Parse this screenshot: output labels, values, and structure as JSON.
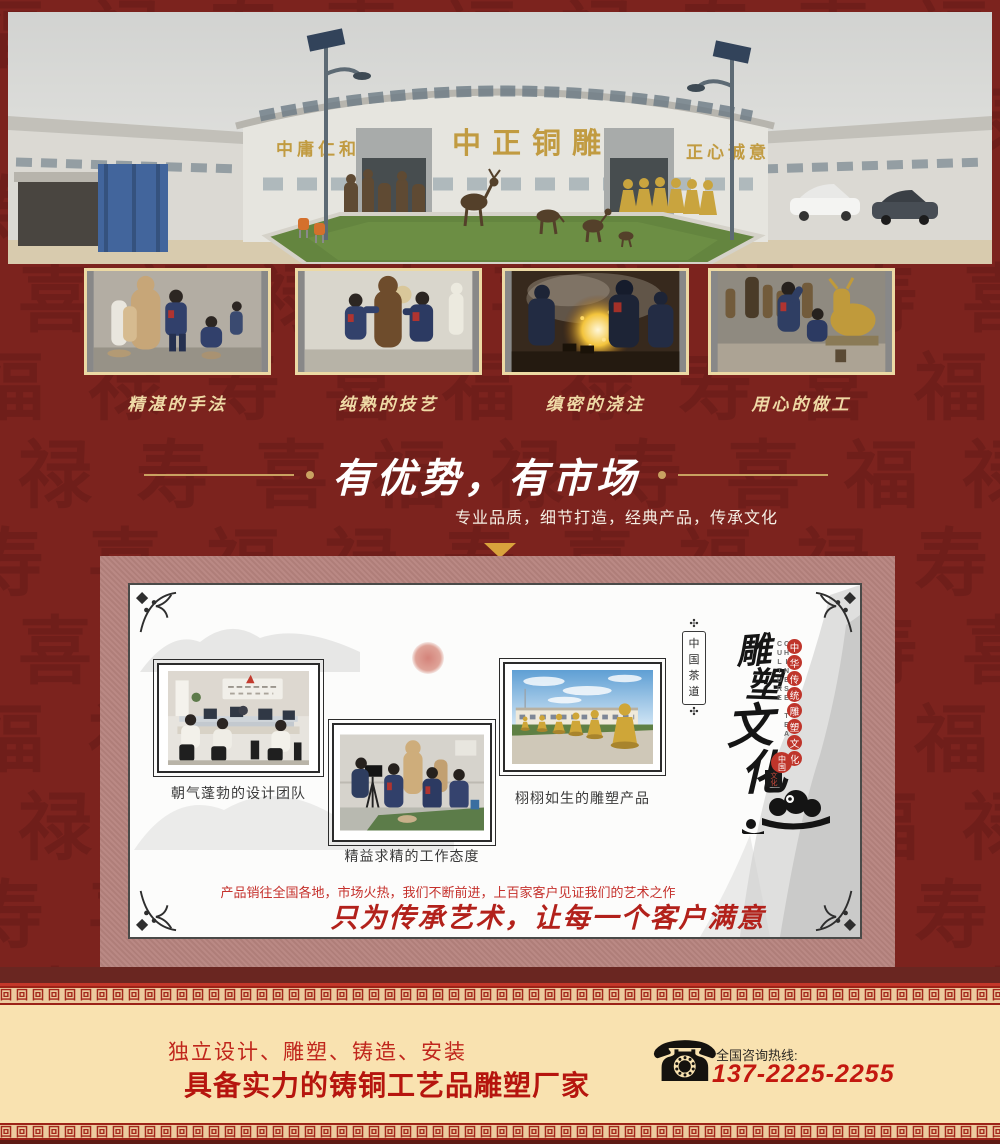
{
  "hero": {
    "sign_left": "中庸仁和",
    "sign_center": "中正铜雕",
    "sign_right": "正心诚意"
  },
  "process": {
    "items": [
      "精湛的手法",
      "纯熟的技艺",
      "缜密的浇注",
      "用心的做工"
    ]
  },
  "advantage": {
    "title": "有优势，有市场",
    "subtitle": "专业品质，细节打造，经典产品，传承文化"
  },
  "culture": {
    "captions": [
      "朝气蓬勃的设计团队",
      "精益求精的工作态度",
      "栩栩如生的雕塑产品"
    ],
    "plaque": "中国茶道",
    "brand_vertical": "雕塑文化",
    "english": "CHINESE TEA CULTURE",
    "ring_text": "中华传统雕塑文化",
    "seal_red": "中国",
    "seal_black": "文化",
    "note": "产品销往全国各地，市场火热，我们不断前进，上百家客户见证我们的艺术之作",
    "slogan": "只为传承艺术，让每一个客户满意"
  },
  "footer": {
    "line1": "独立设计、雕塑、铸造、安装",
    "line2": "具备实力的铸铜工艺品雕塑厂家",
    "hotline_label": "全国咨询热线:",
    "phone": "137-2225-2255",
    "phone_icon": "telephone-icon"
  },
  "decor": {
    "meander_glyph": "回",
    "pattern_chars": [
      "福",
      "禄",
      "寿",
      "喜"
    ]
  },
  "colors": {
    "background": "#7c231e",
    "panel": "#b6837e",
    "cream": "#f9e2b0",
    "accent_red": "#c2251a",
    "gold": "#c9a261"
  }
}
